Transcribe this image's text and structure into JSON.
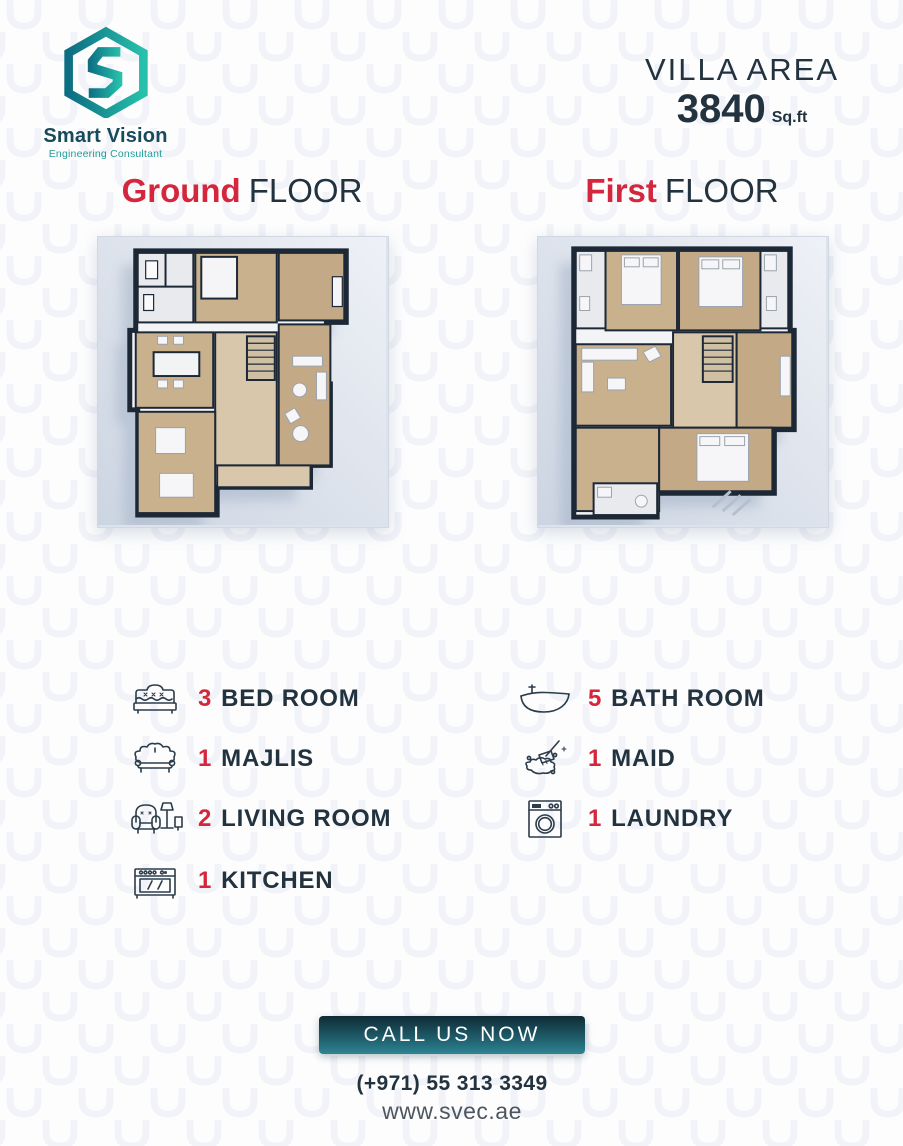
{
  "header": {
    "logo": {
      "brand": "Smart Vision",
      "tagline": "Engineering Consultant"
    },
    "villa_area": {
      "label": "VILLA AREA",
      "value": "3840",
      "unit": "Sq.ft"
    }
  },
  "floors": [
    {
      "highlight": "Ground",
      "rest": "FLOOR"
    },
    {
      "highlight": "First",
      "rest": "FLOOR"
    }
  ],
  "features": {
    "left": [
      {
        "count": "3",
        "label": "BED ROOM",
        "icon": "bed-icon"
      },
      {
        "count": "1",
        "label": "MAJLIS",
        "icon": "sofa-icon"
      },
      {
        "count": "2",
        "label": "LIVING ROOM",
        "icon": "armchair-lamp-icon"
      },
      {
        "count": "1",
        "label": "KITCHEN",
        "icon": "stove-icon"
      }
    ],
    "right": [
      {
        "count": "5",
        "label": "BATH ROOM",
        "icon": "bathtub-icon"
      },
      {
        "count": "1",
        "label": "MAID",
        "icon": "cleaning-brush-icon"
      },
      {
        "count": "1",
        "label": "LAUNDRY",
        "icon": "washing-machine-icon"
      }
    ]
  },
  "footer": {
    "cta": "CALL US NOW",
    "phone": "(+971) 55 313 3349",
    "website": "www.svec.ae"
  },
  "colors": {
    "accent_red": "#d4263c",
    "dark_navy": "#22333f",
    "teal": "#1f9d97",
    "teal_dark": "#174a5a",
    "button_gradient_top": "#102b36",
    "button_gradient_bottom": "#2e8494"
  }
}
